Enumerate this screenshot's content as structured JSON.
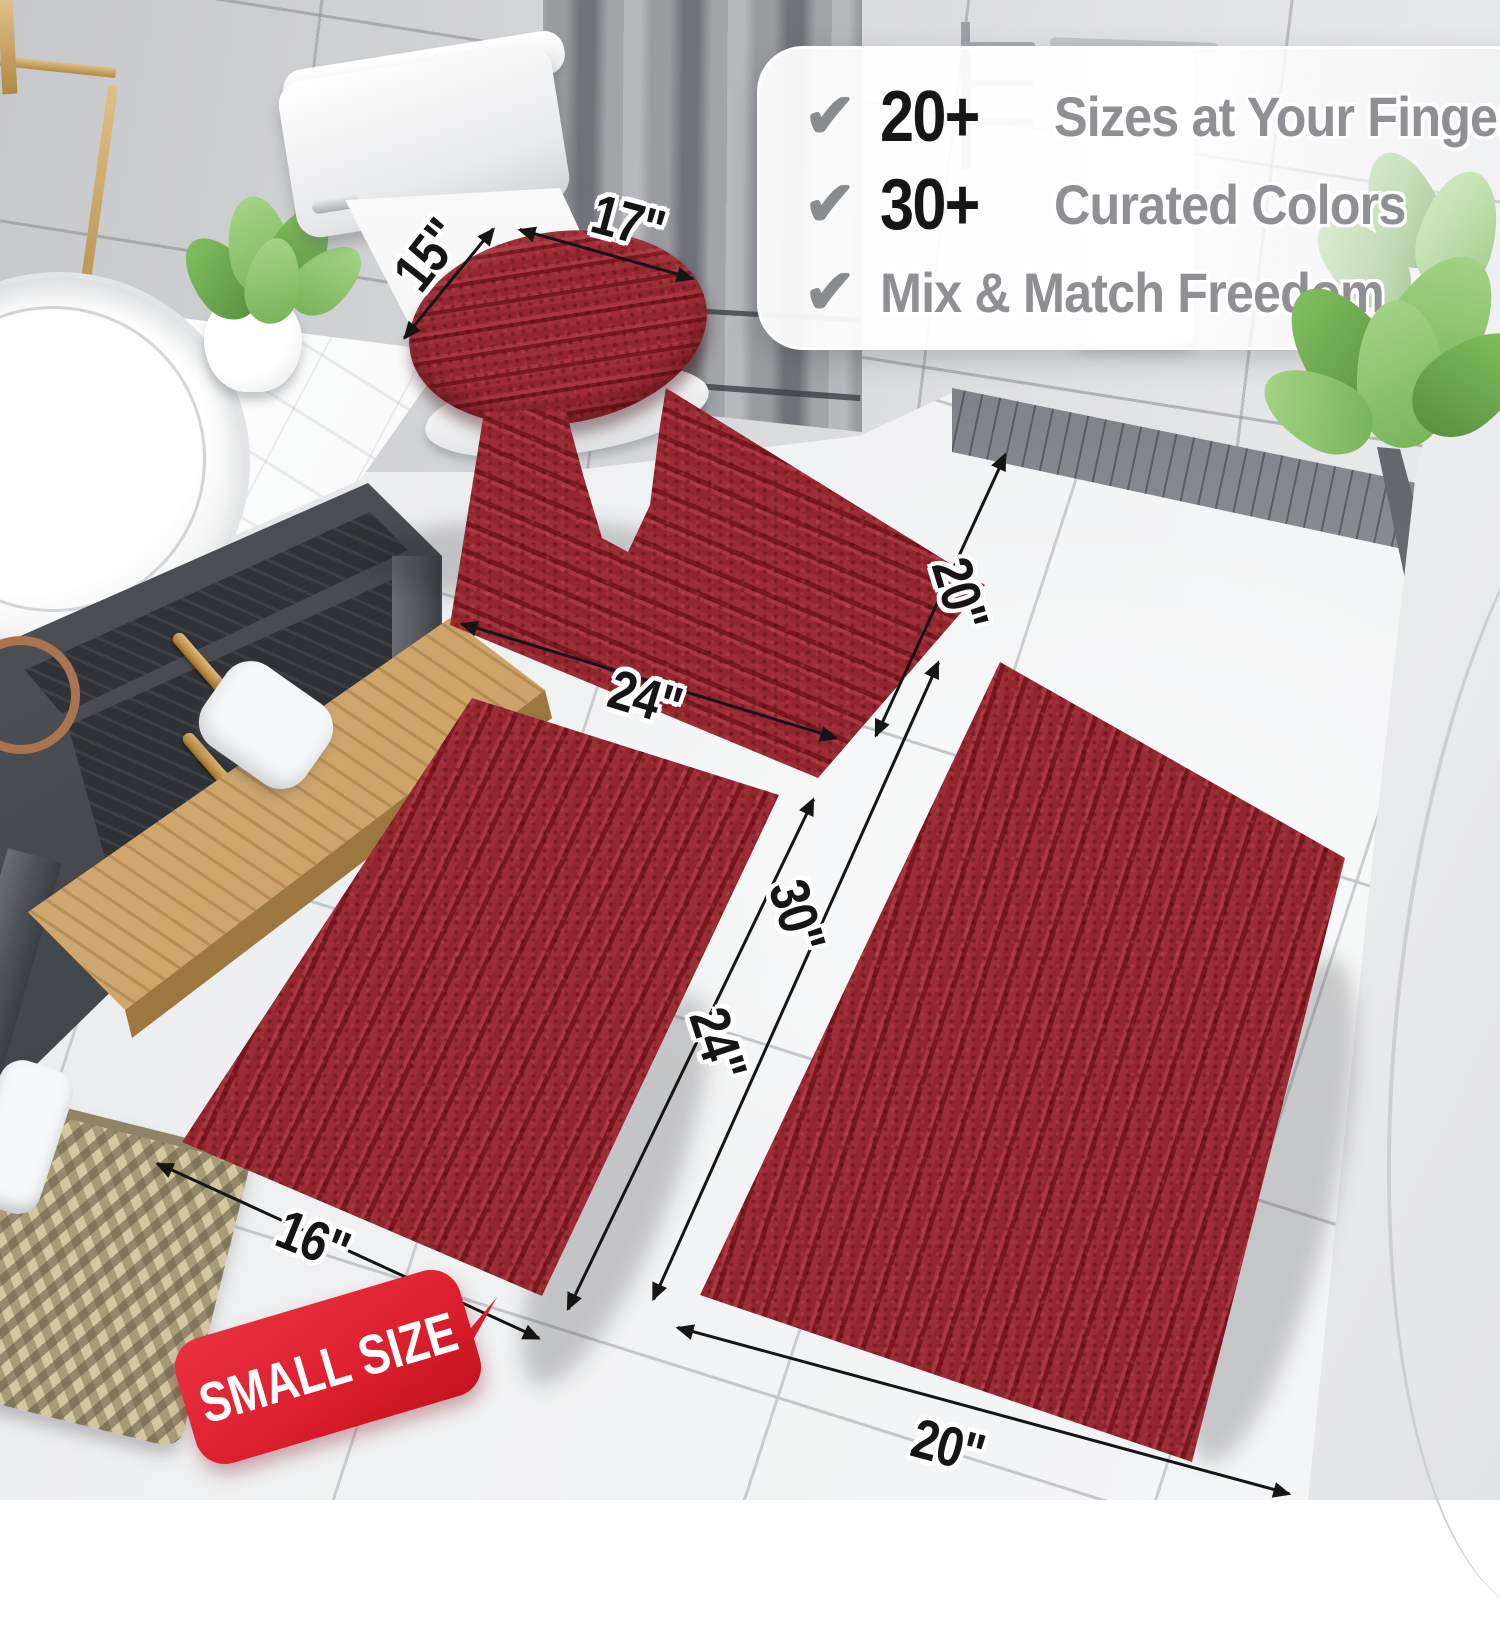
{
  "callout": {
    "check_icon": "✔",
    "items": [
      {
        "count": "20+",
        "label": "Sizes at Your Fingertips"
      },
      {
        "count": "30+",
        "label": "Curated Colors"
      },
      {
        "count": "",
        "label": "Mix & Match Freedom"
      }
    ]
  },
  "dimensions": {
    "lid_width": "15\"",
    "lid_length": "17\"",
    "contour_width": "24\"",
    "contour_height": "20\"",
    "runner_length": "30\"",
    "small_length": "24\"",
    "small_width": "16\"",
    "runner_width": "20\""
  },
  "badge": {
    "label": "SMALL SIZE"
  },
  "colors": {
    "rug_red": "#9b2a33",
    "rug_red_light": "#a83741",
    "rug_red_dark": "#76161e",
    "rug_backing": "#6d1118",
    "badge_red": "#dc1f2e",
    "gold": "#c7a05e",
    "number_black": "#161616",
    "feature_gray": "#8f9094",
    "check_gray": "#8a8d90",
    "dim_black": "#151515"
  }
}
